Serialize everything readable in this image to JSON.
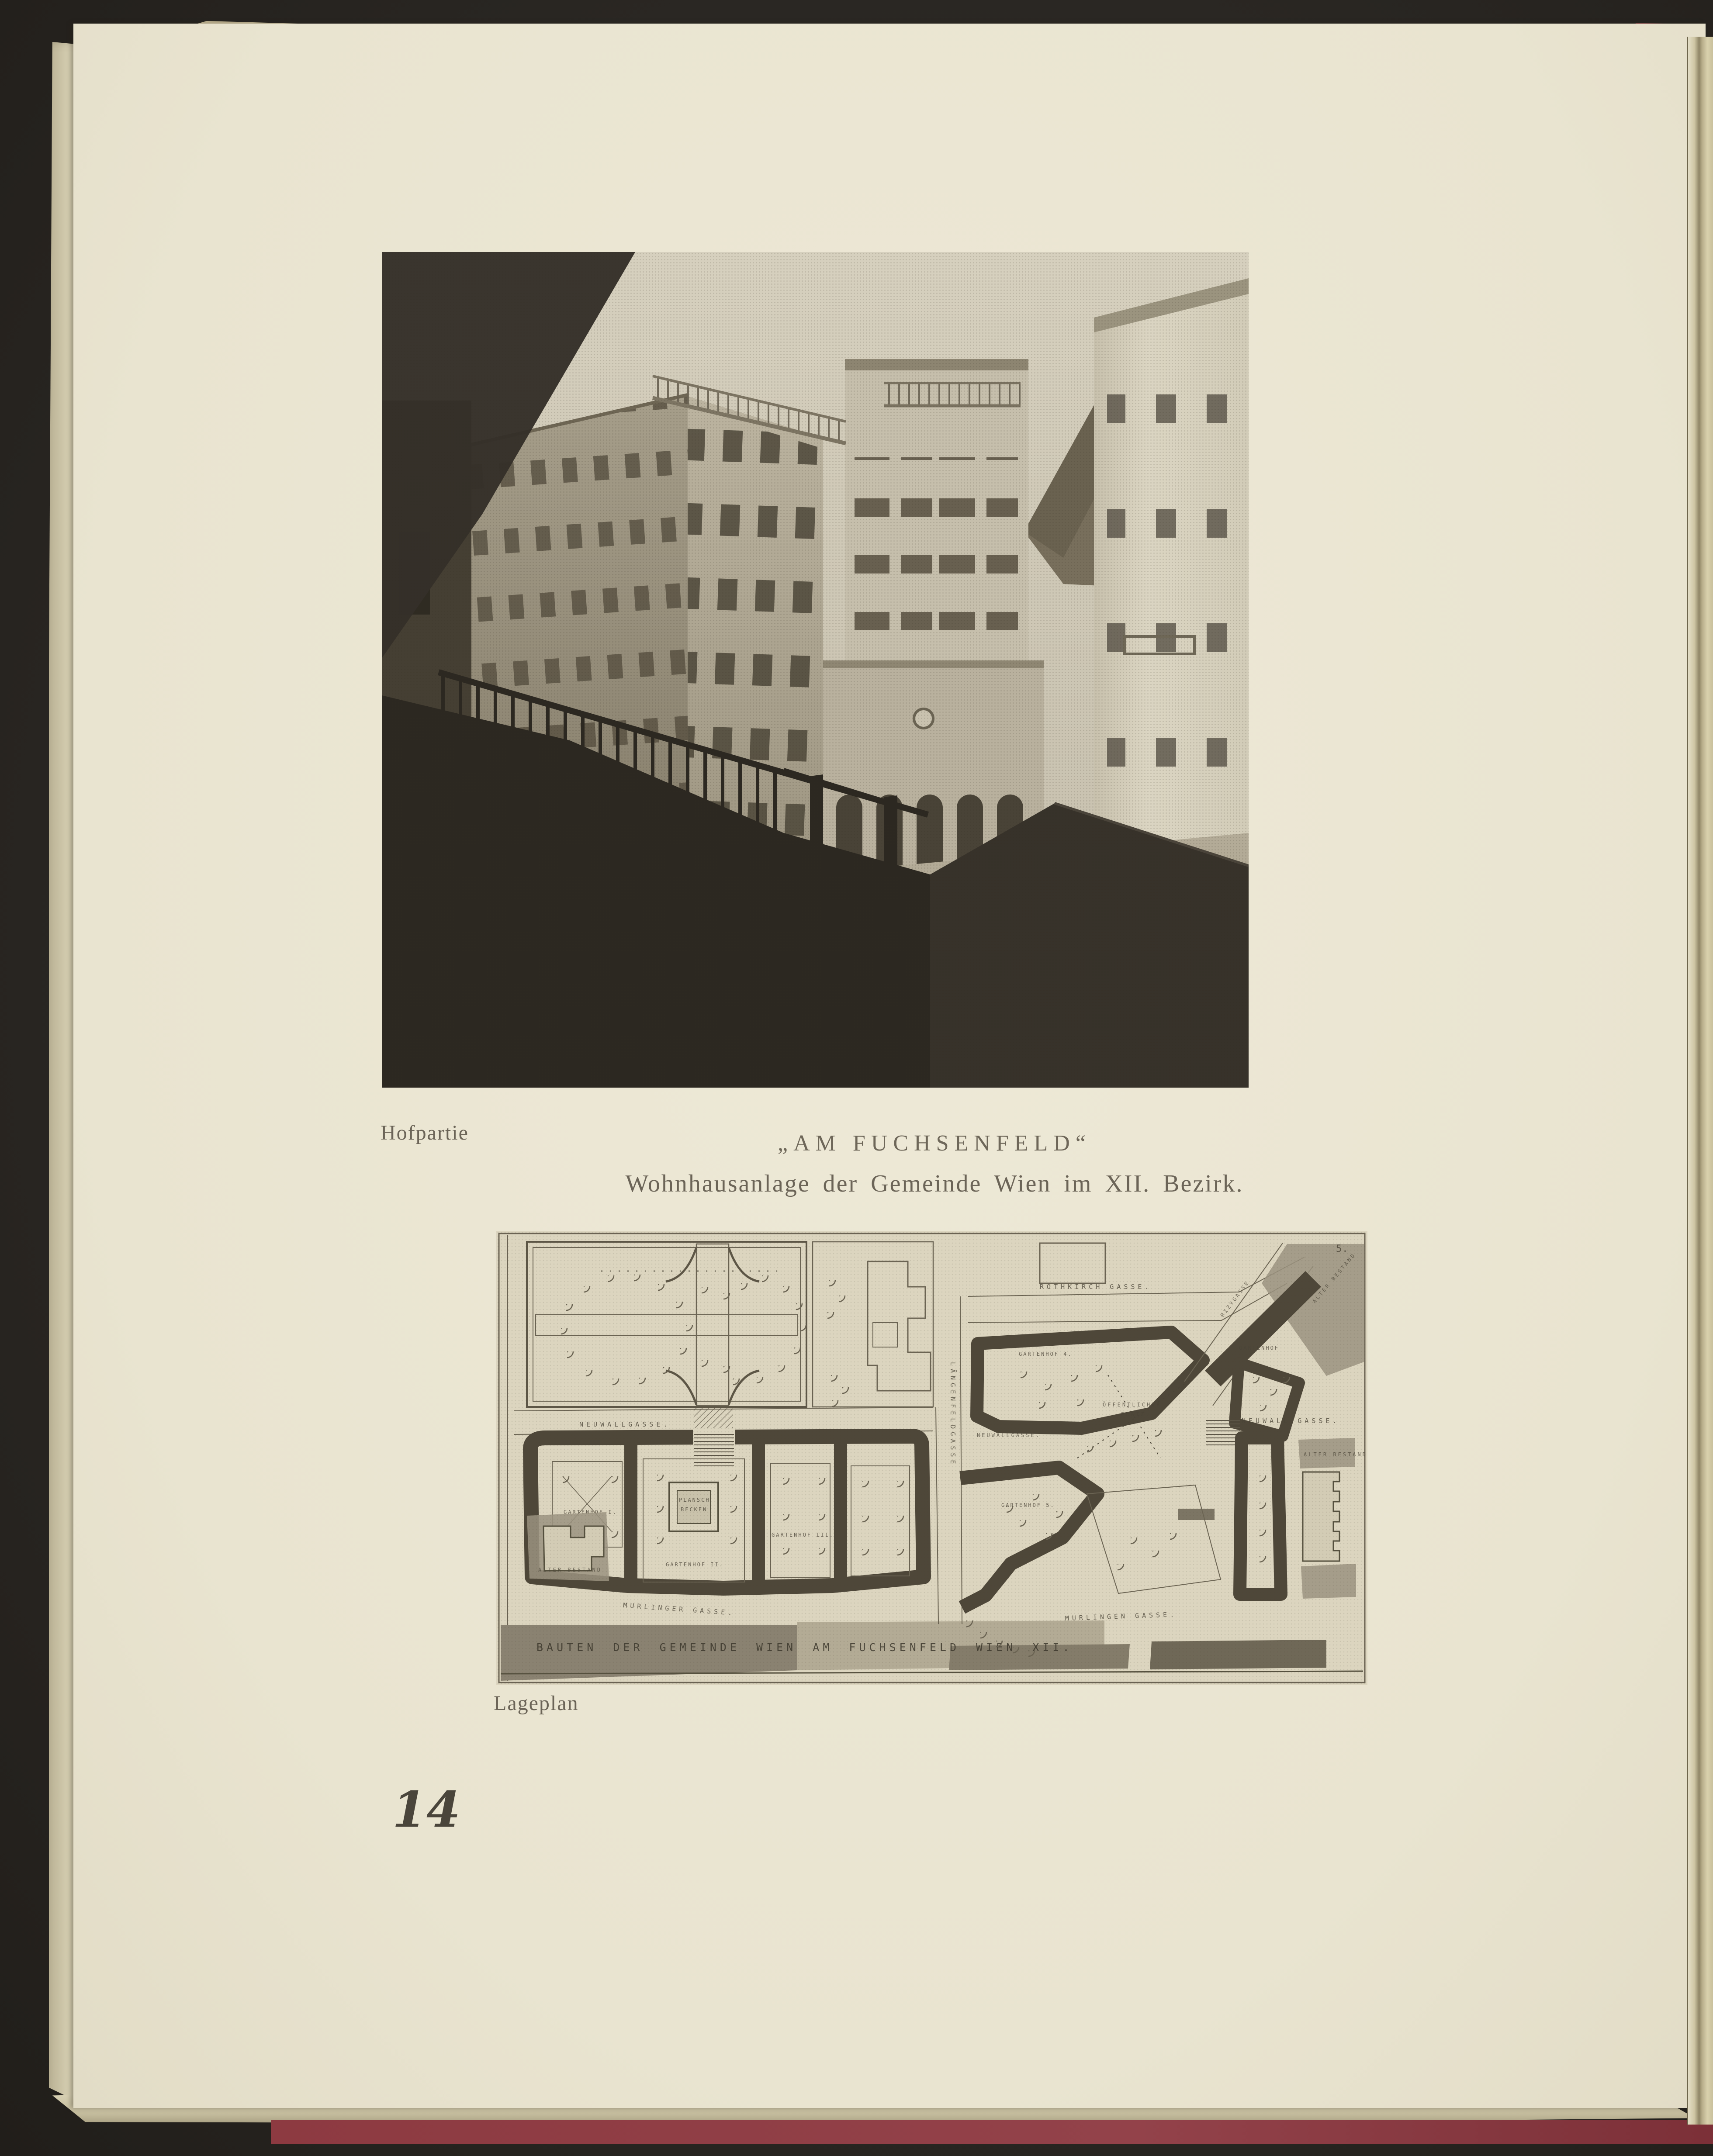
{
  "page": {
    "photo_caption": "Hofpartie",
    "title": "„AM FUCHSENFELD“",
    "subtitle": "Wohnhausanlage der Gemeinde Wien im XII. Bezirk.",
    "plan_caption": "Lageplan",
    "page_number": "14"
  },
  "plan": {
    "plate_number": "5.",
    "caption_band": "BAUTEN DER GEMEINDE WIEN AM FUCHSENFELD WIEN XII.",
    "streets": {
      "neuwallgasse_left": "NEUWALLGASSE.",
      "murlingergasse_left": "MURLINGER GASSE.",
      "laengenfeldgasse": "LÄNGENFELDGASSE",
      "rothkirchgasse": "ROTHKIRCH GASSE.",
      "rizygasse": "RIZYGASSE",
      "neuwallgasse_right": "NEUWALL GASSE.",
      "neuwallgasse_inner": "NEUWALLGASSE.",
      "murlingergasse_right": "MURLINGEN GASSE."
    },
    "places": {
      "oeffentlicher_platz_line1": "ÖFFENTLICHER",
      "oeffentlicher_platz_line2": "PLATZ.",
      "planschbecken_line1": "PLANSCH",
      "planschbecken_line2": "BECKEN",
      "gartenhof_1": "GARTENHOF I.",
      "gartenhof_2": "GARTENHOF II.",
      "gartenhof_3": "GARTENHOF III.",
      "gartenhof_4": "GARTENHOF 4.",
      "gartenhof_5": "GARTENHOF 5.",
      "gartenhof_6": "GARTENHOF",
      "alter_bestand_1": "ALTER BESTAND",
      "alter_bestand_2": "ALTER BESTAND",
      "alter_bestand_3": "ALTER BESTAND"
    }
  },
  "colors": {
    "page_paper": "#ebe6d3",
    "under_page": "#d8d0b4",
    "scan_background": "#2b2826",
    "cover_red": "#8d3a41",
    "caption_ink": "#6b6457",
    "plan_paper": "#dcd5bf",
    "plan_ink": "#4e4739"
  }
}
